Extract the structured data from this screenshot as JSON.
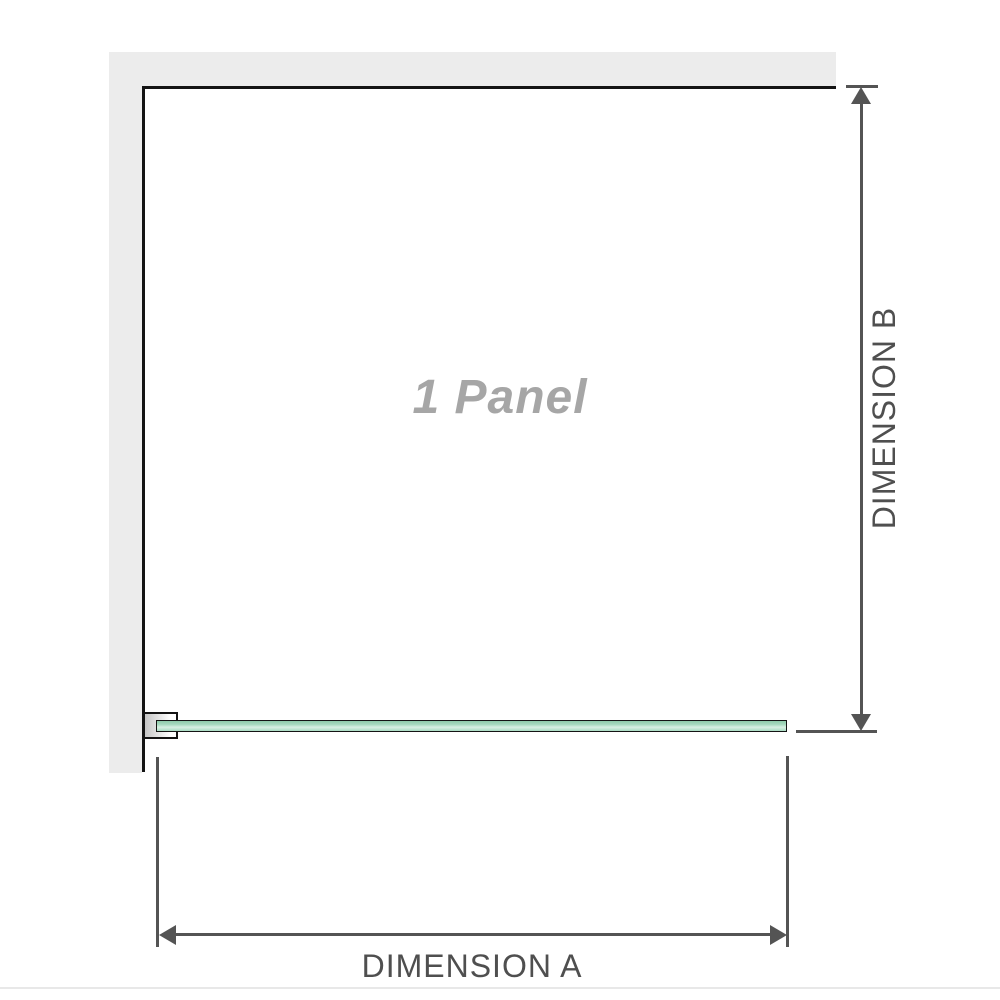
{
  "diagram": {
    "panel_label": "1 Panel",
    "dimension_a_label": "DIMENSION A",
    "dimension_b_label": "DIMENSION B"
  },
  "colors": {
    "page_bg": "#ffffff",
    "wall_fill": "#ececec",
    "outline": "#141414",
    "dim": "#545454",
    "dim_text": "#4f4f4f",
    "glass_top": "#8ecbaa",
    "glass_mid": "#d8f0e2",
    "glass_base": "#a9dcc3",
    "bracket_start": "#c6c6c6",
    "bracket_end": "#ffffff",
    "panel_label": "#a6a6a6",
    "footer_rule": "#e8e8e8"
  }
}
